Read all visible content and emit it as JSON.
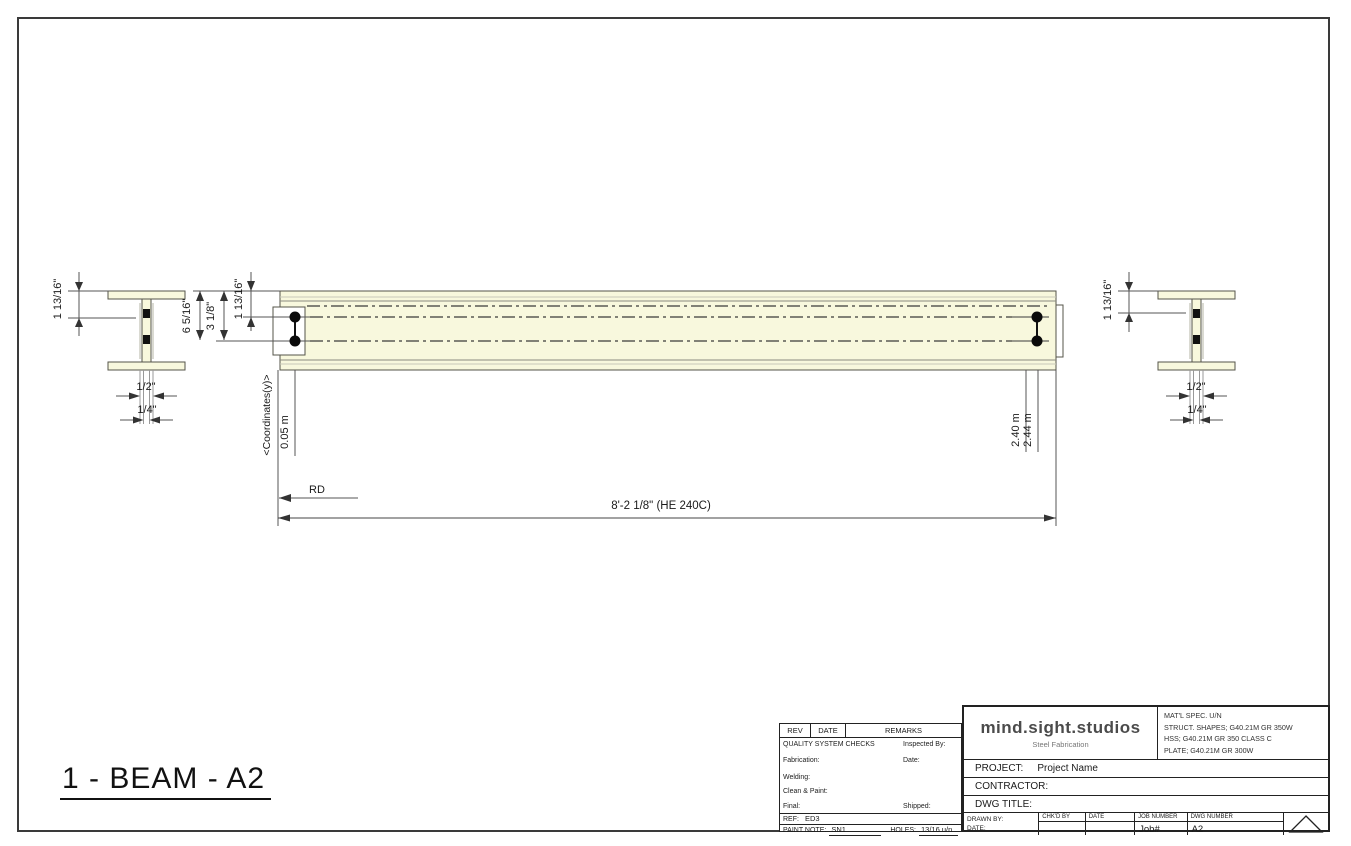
{
  "colors": {
    "beam_fill": "#F8F8DD",
    "line_dark": "#3a3a3a"
  },
  "drawing": {
    "title": "1 - BEAM - A2",
    "left_section": {
      "dim_top": "1 13/16\"",
      "dim_half": "1/2\"",
      "dim_quarter": "1/4\""
    },
    "right_section": {
      "dim_top": "1 13/16\"",
      "dim_half": "1/2\"",
      "dim_quarter": "1/4\""
    },
    "elevation": {
      "dim_depth": "6 5/16\"",
      "dim_hole_row2": "3 1/8\"",
      "dim_hole_row1": "1 13/16\"",
      "coord_axis_label": "<Coordinates(y)>",
      "coord_start": "0.05 m",
      "coord_hole_right": "2.40 m",
      "coord_end": "2.44 m",
      "datum_label": "RD",
      "overall_length": "8'-2 1/8\" (HE 240C)"
    }
  },
  "title_block": {
    "rev_header": {
      "rev": "REV",
      "date": "DATE",
      "remarks": "REMARKS"
    },
    "quality": {
      "title": "QUALITY SYSTEM CHECKS",
      "inspected_by": "Inspected By:",
      "fabrication": "Fabrication:",
      "date": "Date:",
      "welding": "Welding:",
      "clean_paint": "Clean & Paint:",
      "final": "Final:",
      "shipped": "Shipped:"
    },
    "ref": {
      "label": "REF:",
      "value": "ED3"
    },
    "paint_note": {
      "label": "PAINT NOTE:",
      "value": "SN1",
      "holes_label": "HOLES:",
      "holes_value": "13/16 u/n"
    },
    "company": {
      "name": "mind.sight.studios",
      "tagline": "Steel Fabrication"
    },
    "material_spec": {
      "line1": "MAT'L SPEC. U/N",
      "line2": "STRUCT. SHAPES; G40.21M GR 350W",
      "line3": "HSS; G40.21M GR 350 CLASS C",
      "line4": "PLATE; G40.21M GR 300W"
    },
    "project": {
      "label": "PROJECT:",
      "value": "Project Name"
    },
    "contractor_label": "CONTRACTOR:",
    "dwg_title_label": "DWG TITLE:",
    "footer": {
      "drawn_by": "DRAWN BY:",
      "date": "DATE:",
      "chkd_by": "CHK'D BY",
      "date2": "DATE",
      "job_number_label": "JOB NUMBER",
      "job_number": "Job#",
      "dwg_number_label": "DWG NUMBER",
      "dwg_number": "A2"
    }
  }
}
